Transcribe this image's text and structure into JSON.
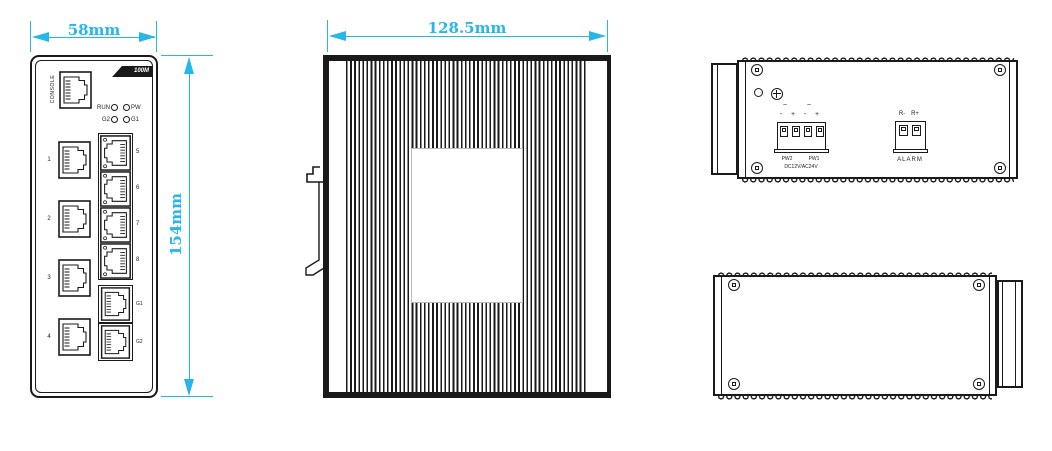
{
  "colors": {
    "dimension_accent": "#25b7e9",
    "line_ink": "#1a1a1a",
    "background": "#ffffff"
  },
  "front_view": {
    "width_dim": "58mm",
    "height_dim": "154mm",
    "speed_badge": "100M",
    "console_label": "CONSOLE",
    "led_run": "RUN",
    "led_pw": "PW",
    "led_g2": "G2",
    "led_g1": "G1",
    "left_ports": [
      "1",
      "2",
      "3",
      "4"
    ],
    "right_ports": [
      "5",
      "6",
      "7",
      "8"
    ],
    "uplink_ports": [
      "G1",
      "G2"
    ]
  },
  "side_view": {
    "width_dim": "128.5mm"
  },
  "top_view": {
    "ac_marks": [
      "~",
      "~"
    ],
    "polarity_signs": [
      "-",
      "+",
      "-",
      "+"
    ],
    "power_port_labels": [
      "PW2",
      "PW1"
    ],
    "voltage_label": "DC12V/AC24V",
    "relay_pin_labels": [
      "R-",
      "R+"
    ],
    "alarm_label": "ALARM"
  }
}
